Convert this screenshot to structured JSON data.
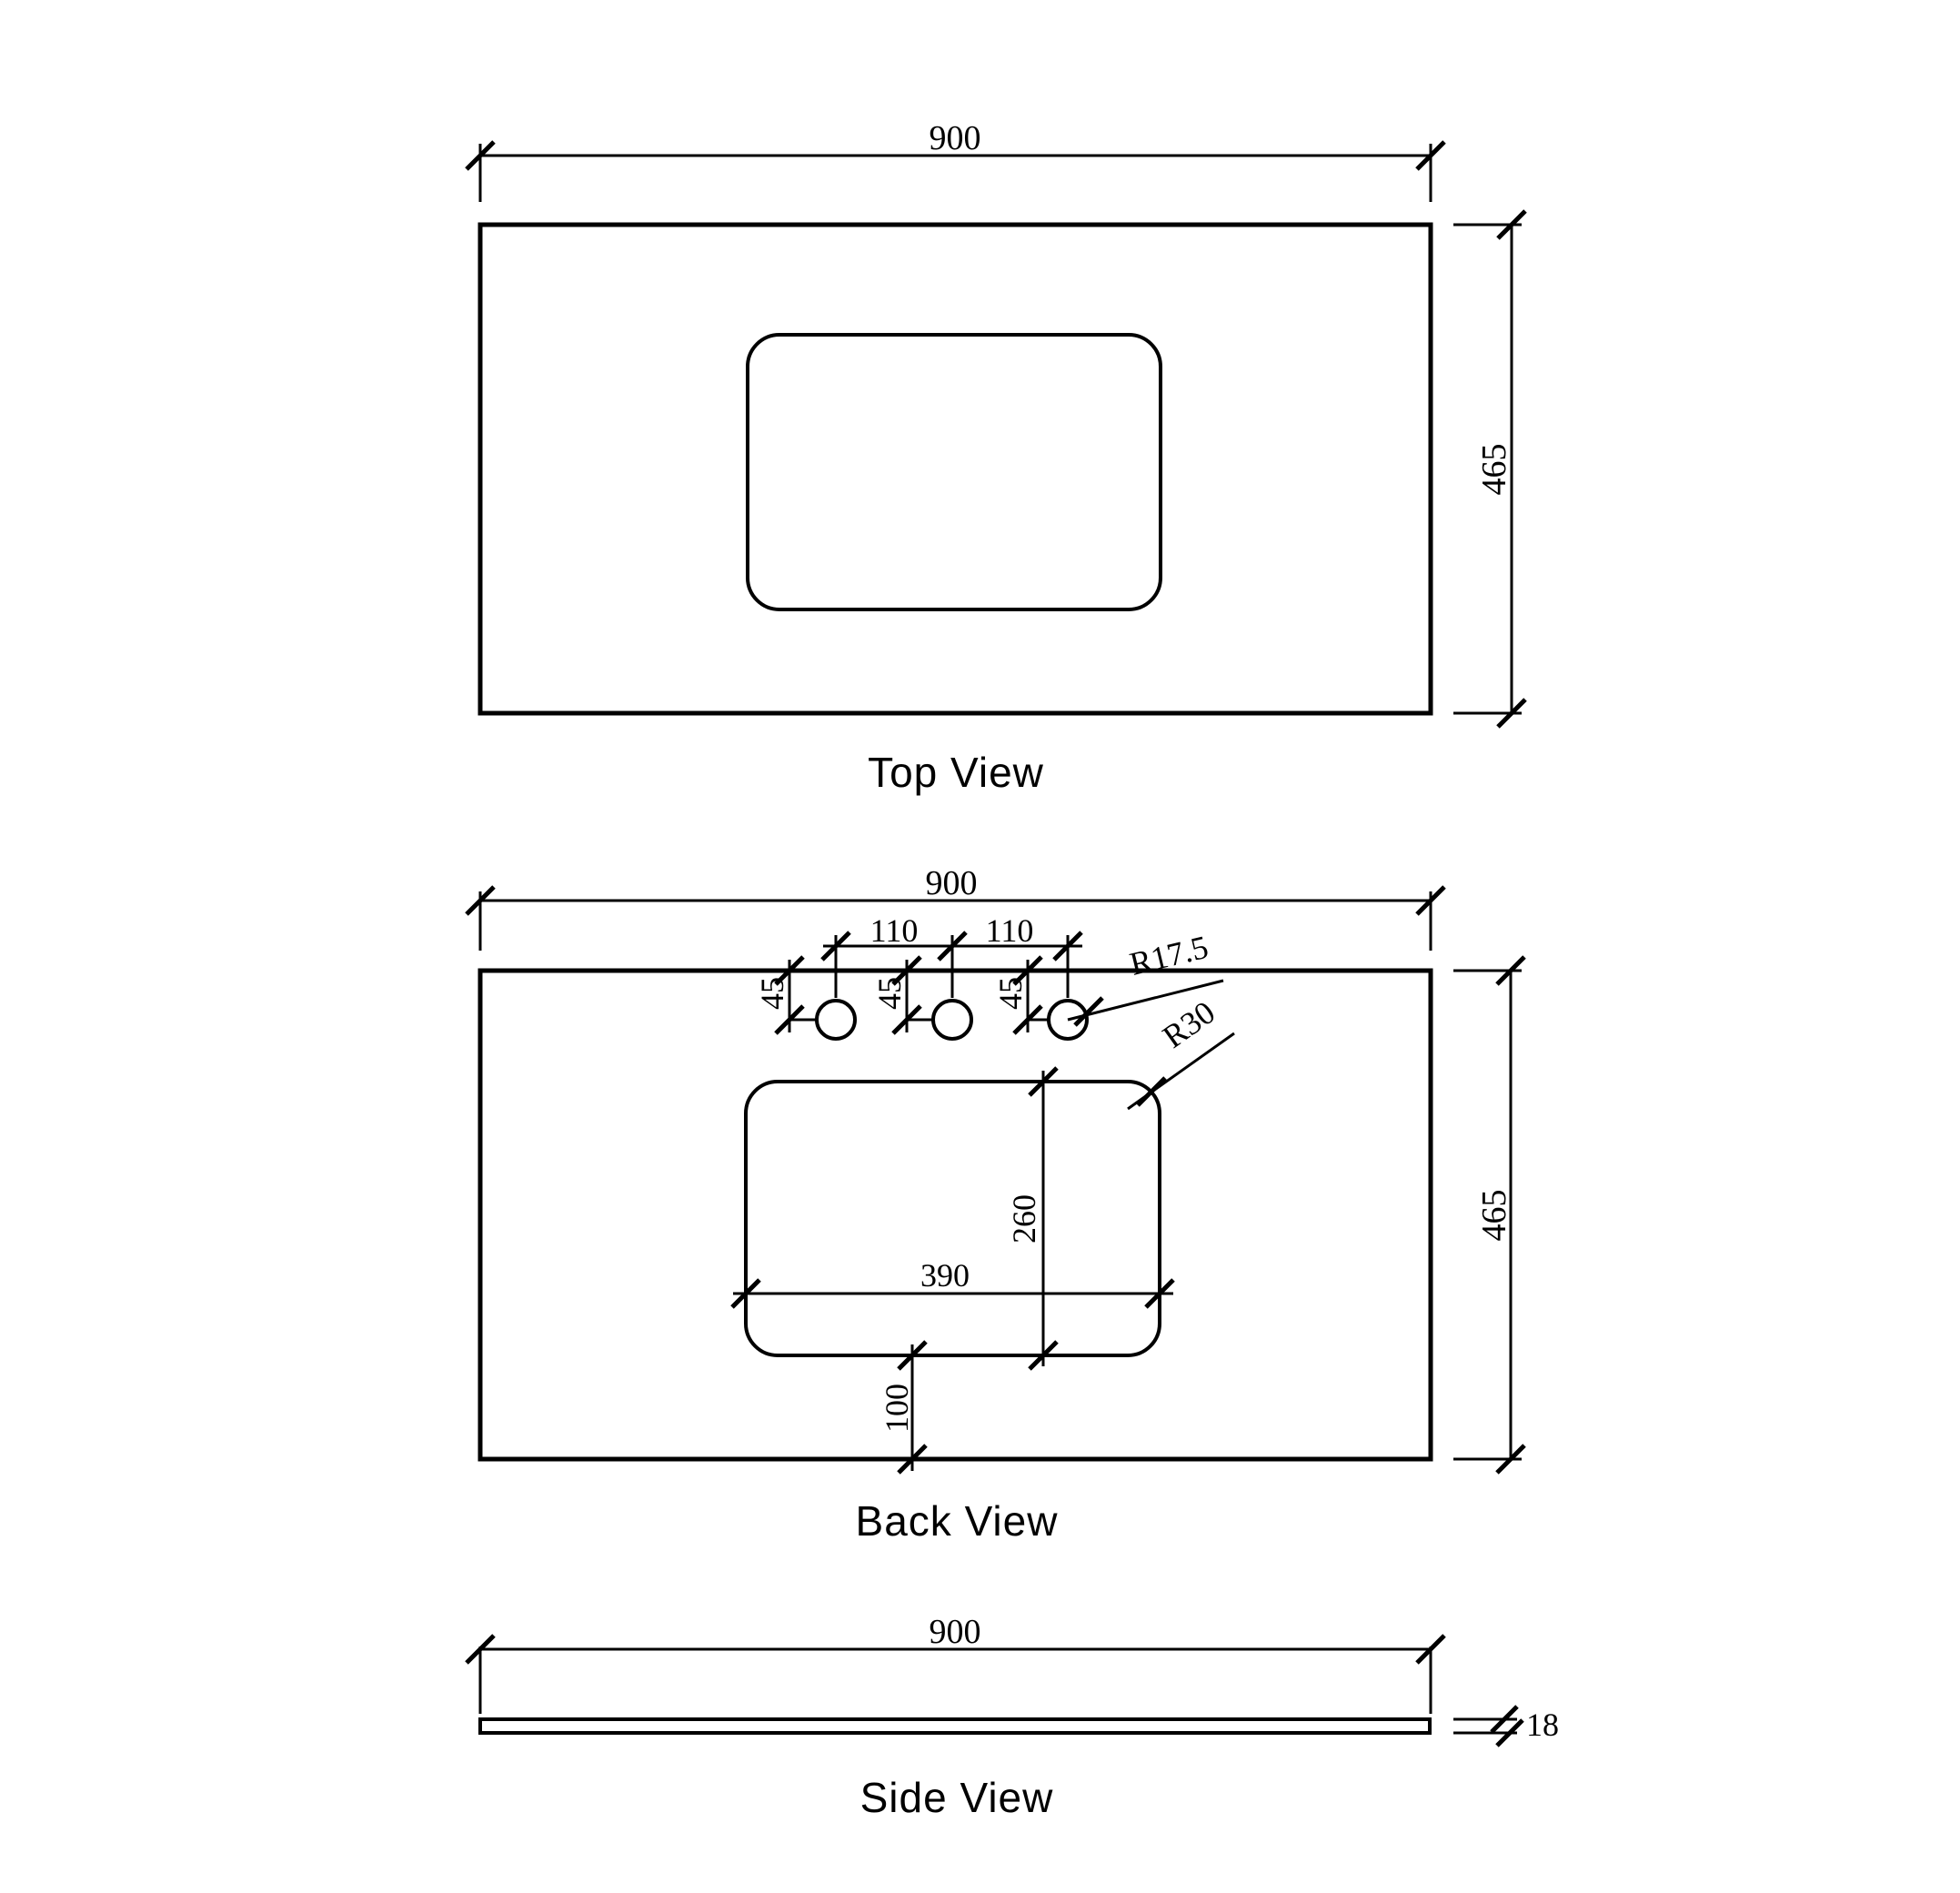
{
  "drawing": {
    "background_color": "#ffffff",
    "line_color": "#000000",
    "views": {
      "top": {
        "label": "Top View",
        "width": "900",
        "height": "465"
      },
      "back": {
        "label": "Back View",
        "width": "900",
        "height": "465",
        "hole_spacings": [
          "110",
          "110"
        ],
        "hole_setbacks": [
          "45",
          "45",
          "45"
        ],
        "hole_radius": "R17.5",
        "cutout_corner_radius": "R30",
        "cutout_width": "390",
        "cutout_height": "260",
        "cutout_bottom_offset": "100"
      },
      "side": {
        "label": "Side View",
        "width": "900",
        "thickness": "18"
      }
    }
  }
}
